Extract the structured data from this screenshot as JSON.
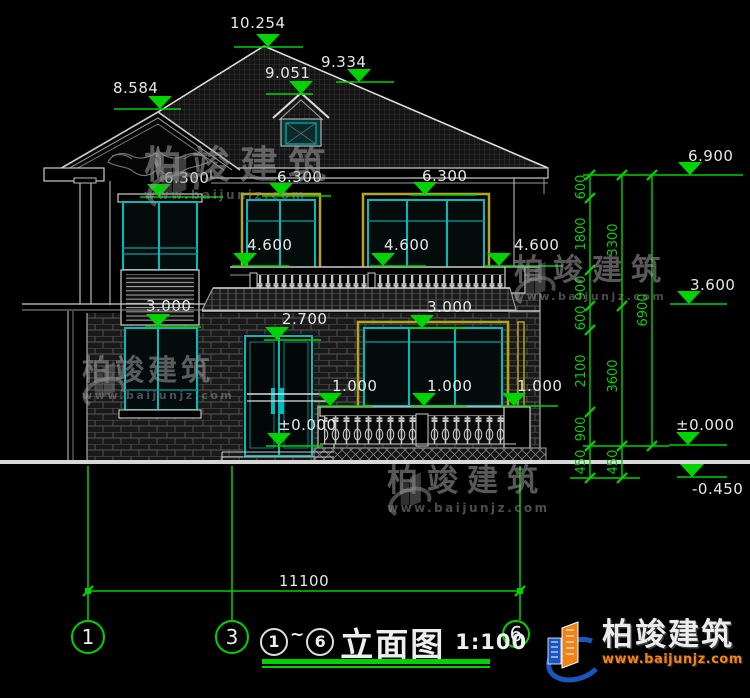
{
  "levels": {
    "ridge": "10.254",
    "roof_right": "9.334",
    "dormer": "9.051",
    "gable": "8.584",
    "eave": "6.300",
    "sill2": "4.600",
    "win1_head": "3.000",
    "door_head": "2.700",
    "rail": "1.000",
    "zero": "±0.000",
    "right_top": "6.900",
    "right_floor2": "3.600",
    "ground_neg": "-0.450"
  },
  "dims": {
    "v1": [
      "600",
      "1800",
      "900",
      "600",
      "2100",
      "900",
      "450"
    ],
    "v2": [
      "3300",
      "3600",
      "450"
    ],
    "v3": [
      "6900"
    ],
    "total": "11100"
  },
  "axes": {
    "a1": "1",
    "a3": "3",
    "a6": "6"
  },
  "title": {
    "start": "1",
    "tilde": "~",
    "end": "6",
    "name": "立面图",
    "scale": "1:100"
  },
  "brand": {
    "name": "柏竣建筑",
    "site": "www.baijunjz.com"
  },
  "colors": {
    "dim_green": "#00d400",
    "frame_cyan": "#00bcbc",
    "frame_teal": "#0a8888",
    "trim_yellow": "#b5a51e",
    "line_white": "#e0e0e0",
    "logo_blue": "#1a56c0",
    "logo_orange": "#ef8418",
    "background": "#000000"
  }
}
